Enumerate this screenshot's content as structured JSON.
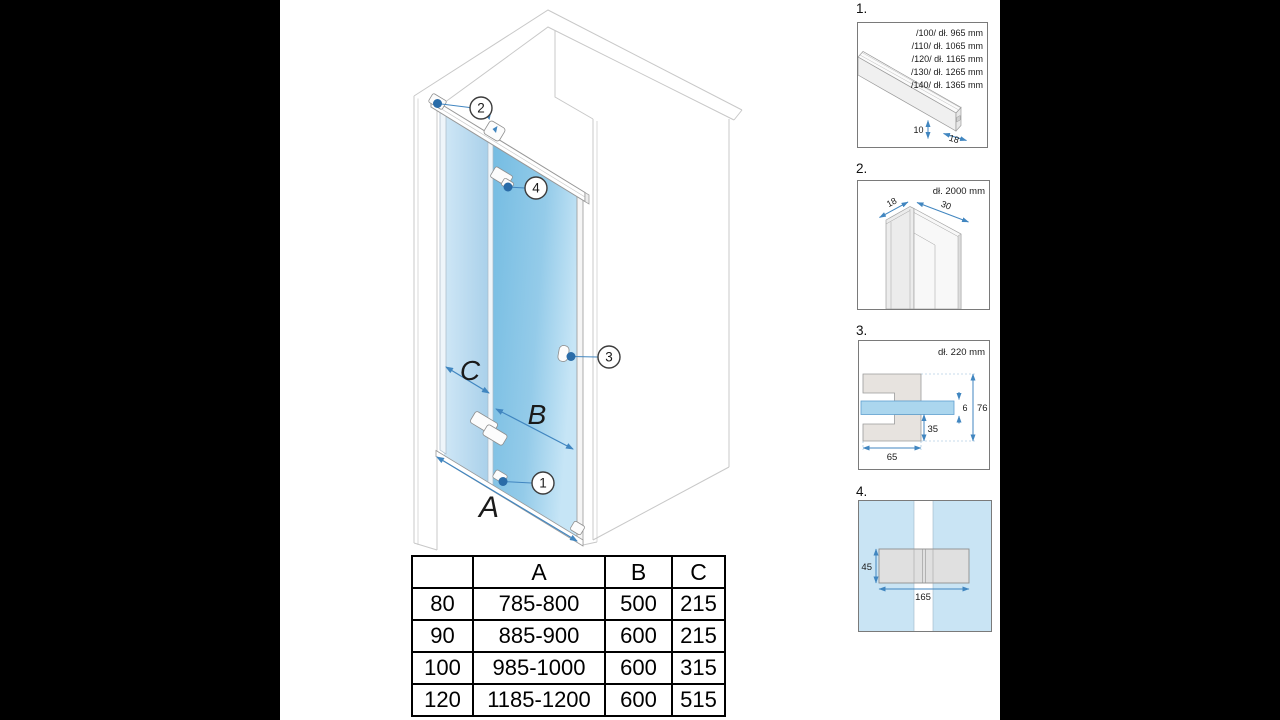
{
  "main_diagram": {
    "dim_labels": {
      "a": "A",
      "b": "B",
      "c": "C"
    },
    "callouts": {
      "c1": "1",
      "c2": "2",
      "c3": "3",
      "c4": "4"
    }
  },
  "size_table": {
    "headers": [
      "",
      "A",
      "B",
      "C"
    ],
    "rows": [
      [
        "80",
        "785-800",
        "500",
        "215"
      ],
      [
        "90",
        "885-900",
        "600",
        "215"
      ],
      [
        "100",
        "985-1000",
        "600",
        "315"
      ],
      [
        "120",
        "1185-1200",
        "600",
        "515"
      ]
    ]
  },
  "details": {
    "d1": {
      "label": "1.",
      "lengths": [
        "/100/ dł. 965 mm",
        "/110/ dł. 1065 mm",
        "/120/ dł. 1165 mm",
        "/130/ dł. 1265 mm",
        "/140/ dł. 1365 mm"
      ],
      "dim_height": "10",
      "dim_width": "18"
    },
    "d2": {
      "label": "2.",
      "length": "dł. 2000 mm",
      "dim_depth": "18",
      "dim_width": "30"
    },
    "d3": {
      "label": "3.",
      "length": "dł. 220 mm",
      "dim_glass_thickness": "6",
      "dim_total_height": "76",
      "dim_lower": "35",
      "dim_arm_width": "65"
    },
    "d4": {
      "label": "4.",
      "dim_height": "45",
      "dim_width": "165"
    }
  },
  "colors": {
    "door_glass": "#7dc2e5",
    "fixed_glass": "#b5d8ec",
    "dimension_blue": "#4186c0",
    "dot_blue": "#2a6ca8",
    "hardware_gray": "#dcdcdc",
    "detail4_bg": "#c9e4f4",
    "wall_line": "#c8c8c8"
  }
}
